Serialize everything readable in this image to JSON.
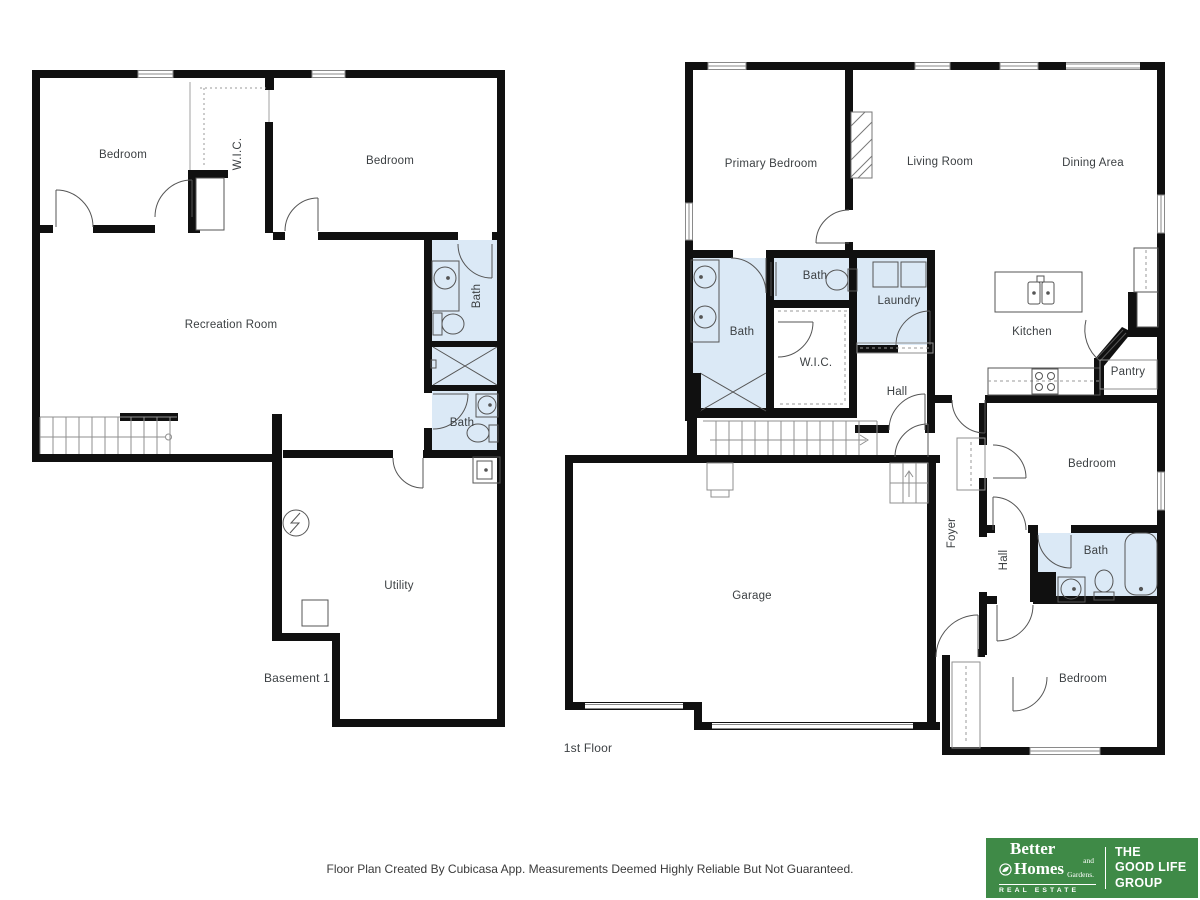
{
  "colors": {
    "wall": "#101010",
    "bath": "#dbe9f6",
    "line": "#555555",
    "thin": "#8f8f8f",
    "label": "#3c4043",
    "logo-green": "#3f8a47"
  },
  "plans": {
    "basement": {
      "title": "Basement 1",
      "rooms": {
        "bedroom_left": "Bedroom",
        "wic": "W.I.C.",
        "bedroom_right": "Bedroom",
        "recreation": "Recreation Room",
        "bath_upper": "Bath",
        "bath_lower": "Bath",
        "utility": "Utility"
      }
    },
    "first_floor": {
      "title": "1st Floor",
      "rooms": {
        "primary_bedroom": "Primary Bedroom",
        "living_room": "Living Room",
        "dining_area": "Dining Area",
        "bath_primary": "Bath",
        "bath_wc": "Bath",
        "laundry": "Laundry",
        "wic": "W.I.C.",
        "hall_center": "Hall",
        "kitchen": "Kitchen",
        "pantry": "Pantry",
        "bedroom_mid": "Bedroom",
        "foyer": "Foyer",
        "hall_right": "Hall",
        "bath_right": "Bath",
        "bedroom_bottom": "Bedroom",
        "garage": "Garage"
      }
    }
  },
  "footer": {
    "disclaimer": "Floor Plan Created By Cubicasa App. Measurements Deemed Highly Reliable But Not Guaranteed."
  },
  "logo": {
    "brand_word1": "Better",
    "brand_word2": "Homes",
    "brand_word3": "and Gardens.",
    "brand_tagline": "REAL ESTATE",
    "group_line1": "THE",
    "group_line2": "GOOD LIFE",
    "group_line3": "GROUP"
  }
}
